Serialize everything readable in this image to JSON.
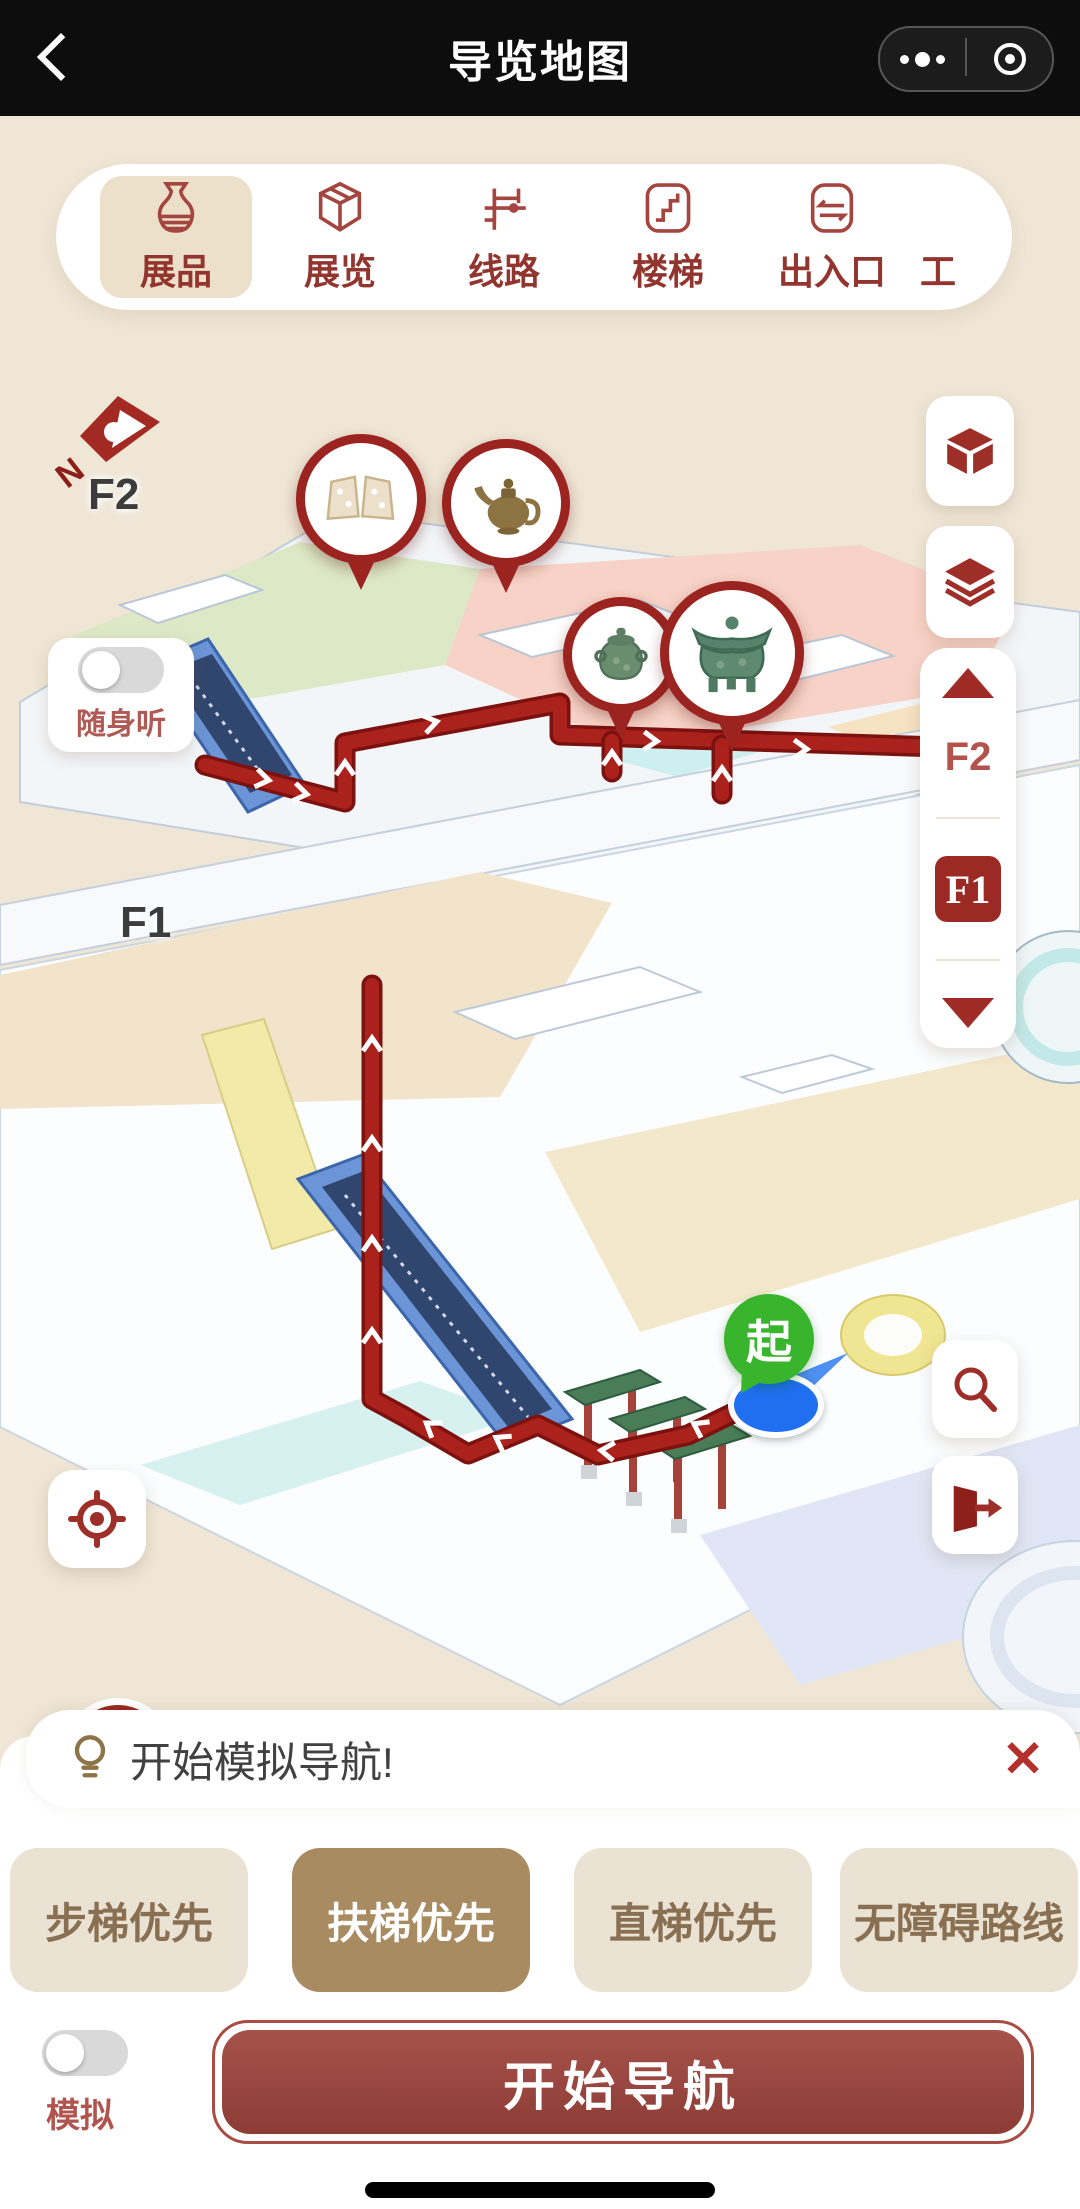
{
  "header": {
    "title": "导览地图",
    "back_icon": "chevron-left",
    "more_icon": "ellipsis-dots",
    "capsule_icon": "target-circle"
  },
  "tabs": [
    {
      "label": "展品",
      "icon": "vase-icon",
      "selected": true
    },
    {
      "label": "展览",
      "icon": "exhibition-box-icon",
      "selected": false
    },
    {
      "label": "线路",
      "icon": "route-path-icon",
      "selected": false
    },
    {
      "label": "楼梯",
      "icon": "stairs-icon",
      "selected": false
    },
    {
      "label": "出入口",
      "icon": "entrance-exit-icon",
      "selected": false
    },
    {
      "label": "工",
      "icon": "clipped",
      "selected": false
    }
  ],
  "map": {
    "compass_label": "N",
    "floor_label_upper": "F2",
    "floor_label_lower": "F1",
    "audio_guide": {
      "label": "随身听",
      "enabled": false
    },
    "start_marker_label": "起",
    "floor_selector": {
      "floors": [
        "F2",
        "F1"
      ],
      "selected": "F1"
    },
    "route_color": "#ab211c",
    "pin_icons": [
      "jade-plaques",
      "bronze-teapot",
      "bronze-jar",
      "bronze-gui-vessel"
    ],
    "side_buttons": [
      "cube-3d-icon",
      "layers-icon",
      "search-icon",
      "exit-door-icon",
      "locate-crosshair-icon"
    ]
  },
  "sheet": {
    "tip": {
      "icon": "lightbulb-icon",
      "text": "开始模拟导航!",
      "close_icon": "✕"
    },
    "route_options": [
      {
        "label": "步梯优先",
        "selected": false
      },
      {
        "label": "扶梯优先",
        "selected": true
      },
      {
        "label": "直梯优先",
        "selected": false
      },
      {
        "label": "无障碍路线",
        "selected": false
      }
    ],
    "simulate": {
      "label": "模拟",
      "enabled": false
    },
    "cta_label": "开始导航"
  }
}
